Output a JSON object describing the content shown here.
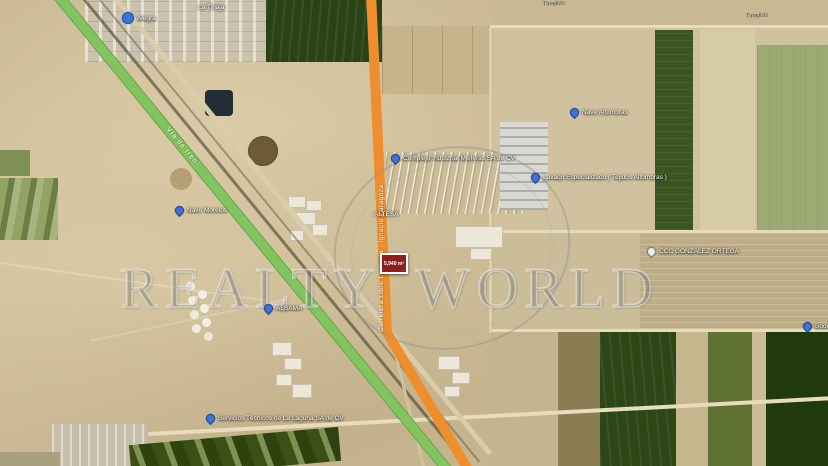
{
  "watermark": {
    "text": "REALTY WORLD"
  },
  "map": {
    "railway": {
      "label": "Vía de tren",
      "color": "#82c45f"
    },
    "highway": {
      "label": "Carretera Libre La Noria - Ignacio Zaragoza",
      "color": "#ef8e2c"
    },
    "area_marker": {
      "label": "5,940 m²",
      "color": "#8e1f1f"
    },
    "place_labels": [
      {
        "text": "La Tinaja",
        "x": 198,
        "y": 4,
        "style": "white"
      },
      {
        "text": "Tinajitas",
        "x": 543,
        "y": 1,
        "style": "road"
      },
      {
        "text": "Tinajitas",
        "x": 746,
        "y": 13,
        "style": "road"
      },
      {
        "text": "ALTESA",
        "x": 374,
        "y": 211,
        "style": "white"
      }
    ],
    "pins": [
      {
        "label": "Alegra",
        "x": 122,
        "y": 12,
        "icon": "poi-dot"
      },
      {
        "label": "Nave Morelos",
        "x": 175,
        "y": 206,
        "icon": "pin-blue"
      },
      {
        "label": "ALBAMA",
        "x": 264,
        "y": 304,
        "icon": "pin-blue"
      },
      {
        "label": "Complejo Industrial Mieleras SA de CV",
        "x": 391,
        "y": 154,
        "icon": "pin-blue"
      },
      {
        "label": "Nave Alfombras",
        "x": 570,
        "y": 108,
        "icon": "pin-blue"
      },
      {
        "label": "Lavado Especializado ( Tejidos Alfombras )",
        "x": 531,
        "y": 173,
        "icon": "pin-blue"
      },
      {
        "label": "CCC GONZALEZ ORTEGA",
        "x": 647,
        "y": 247,
        "icon": "pin-white"
      },
      {
        "label": "Servicios Técnicos de La Laguna SA de CV",
        "x": 206,
        "y": 414,
        "icon": "pin-blue"
      },
      {
        "label": "Bodega",
        "x": 803,
        "y": 322,
        "icon": "pin-blue"
      }
    ]
  }
}
